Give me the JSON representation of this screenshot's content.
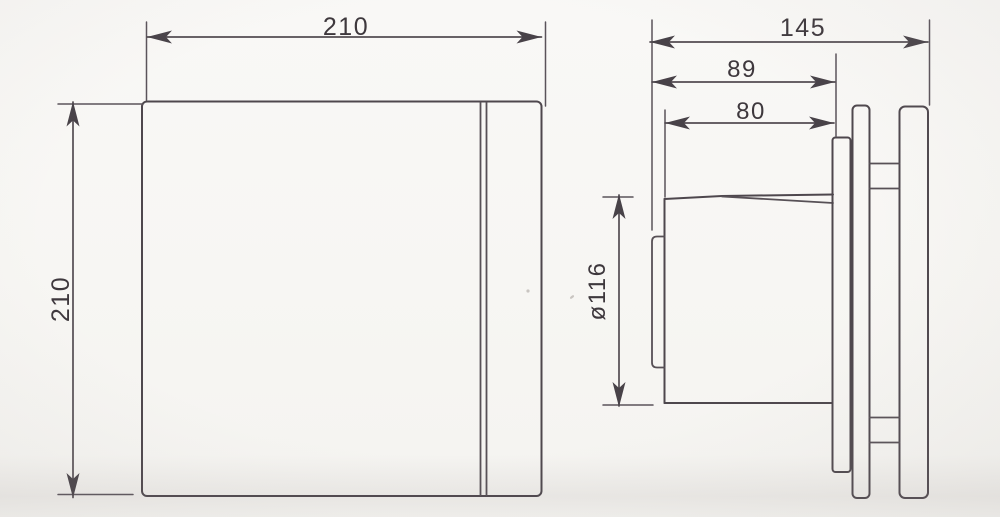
{
  "drawing_type": "technical-dimension-drawing",
  "colors": {
    "paper": "#f7f6f3",
    "ink": "#4e474d",
    "text": "#3e383d"
  },
  "front_view": {
    "width_dim": "210",
    "height_dim": "210"
  },
  "side_view": {
    "overall_depth_dim": "145",
    "mount_depth_dim": "89",
    "duct_length_dim": "80",
    "duct_diameter_dim": "ø116"
  }
}
